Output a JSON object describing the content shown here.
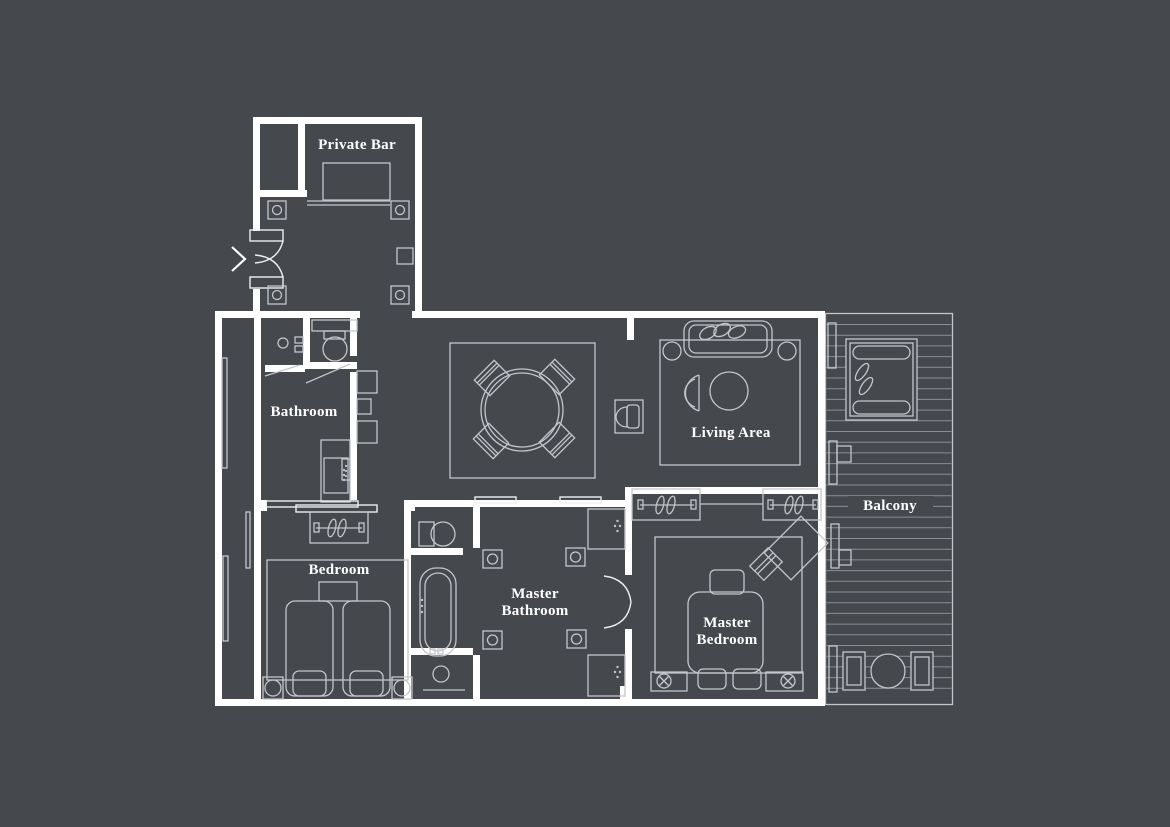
{
  "meta": {
    "type": "floor-plan",
    "description": "Suite floor plan with entry, private bar, two bedrooms, two bathrooms, living area and balcony"
  },
  "colors": {
    "background": "#45484d",
    "walls": "#ffffff",
    "furniture_line": "#c3c7cc",
    "bright_line": "#edeff1",
    "deck_line": "#8a8f96",
    "label_text": "#ffffff"
  },
  "rooms": {
    "private_bar": {
      "label": "Private Bar"
    },
    "bathroom": {
      "label": "Bathroom"
    },
    "bedroom": {
      "label": "Bedroom"
    },
    "master_bathroom": {
      "line1": "Master",
      "line2": "Bathroom"
    },
    "master_bedroom": {
      "line1": "Master",
      "line2": "Bedroom"
    },
    "living_area": {
      "label": "Living Area"
    },
    "balcony": {
      "label": "Balcony"
    }
  },
  "entry": {
    "arrow_direction": "right"
  },
  "furniture": {
    "private_bar": [
      "bar-counter",
      "shelf",
      "wall-sconce",
      "wall-sconce",
      "wall-sconce",
      "wall-sconce",
      "wall-panel",
      "entry-double-door"
    ],
    "hallway": [
      "shelf-unit",
      "shelf-unit",
      "shelf-unit",
      "towel-rail"
    ],
    "bathroom": [
      "toilet",
      "sink",
      "door-swing",
      "door-swing",
      "cabinet"
    ],
    "bedroom": [
      "sliding-door",
      "wardrobe-with-hangers",
      "rug",
      "nightstand",
      "twin-bed",
      "twin-bed",
      "bedside-lamp",
      "bedside-lamp",
      "curtain",
      "curtain",
      "curtain"
    ],
    "dining": [
      "rug",
      "round-dining-table",
      "chair",
      "chair",
      "chair",
      "chair",
      "tv-console"
    ],
    "living_area": [
      "rug",
      "sofa-with-pillows",
      "side-lamp",
      "side-lamp",
      "armchair",
      "round-coffee-table"
    ],
    "master_bathroom": [
      "sliding-window",
      "sliding-window",
      "toilet",
      "bathtub",
      "shower",
      "wall-sconce",
      "wall-sconce",
      "wall-sconce",
      "wall-sconce",
      "vanity-sink",
      "vanity-sink",
      "double-door"
    ],
    "master_bedroom": [
      "closet-with-hangers",
      "closet-with-hangers",
      "rug",
      "king-bed",
      "ottoman",
      "ottoman",
      "nightstand-lamp",
      "nightstand-lamp",
      "desk",
      "desk-chair"
    ],
    "balcony": [
      "daybed-with-pillows",
      "round-table",
      "outdoor-chair",
      "outdoor-chair",
      "deck-boards",
      "sliding-door-frame",
      "sliding-door-frame",
      "window-frame",
      "window-frame"
    ]
  }
}
